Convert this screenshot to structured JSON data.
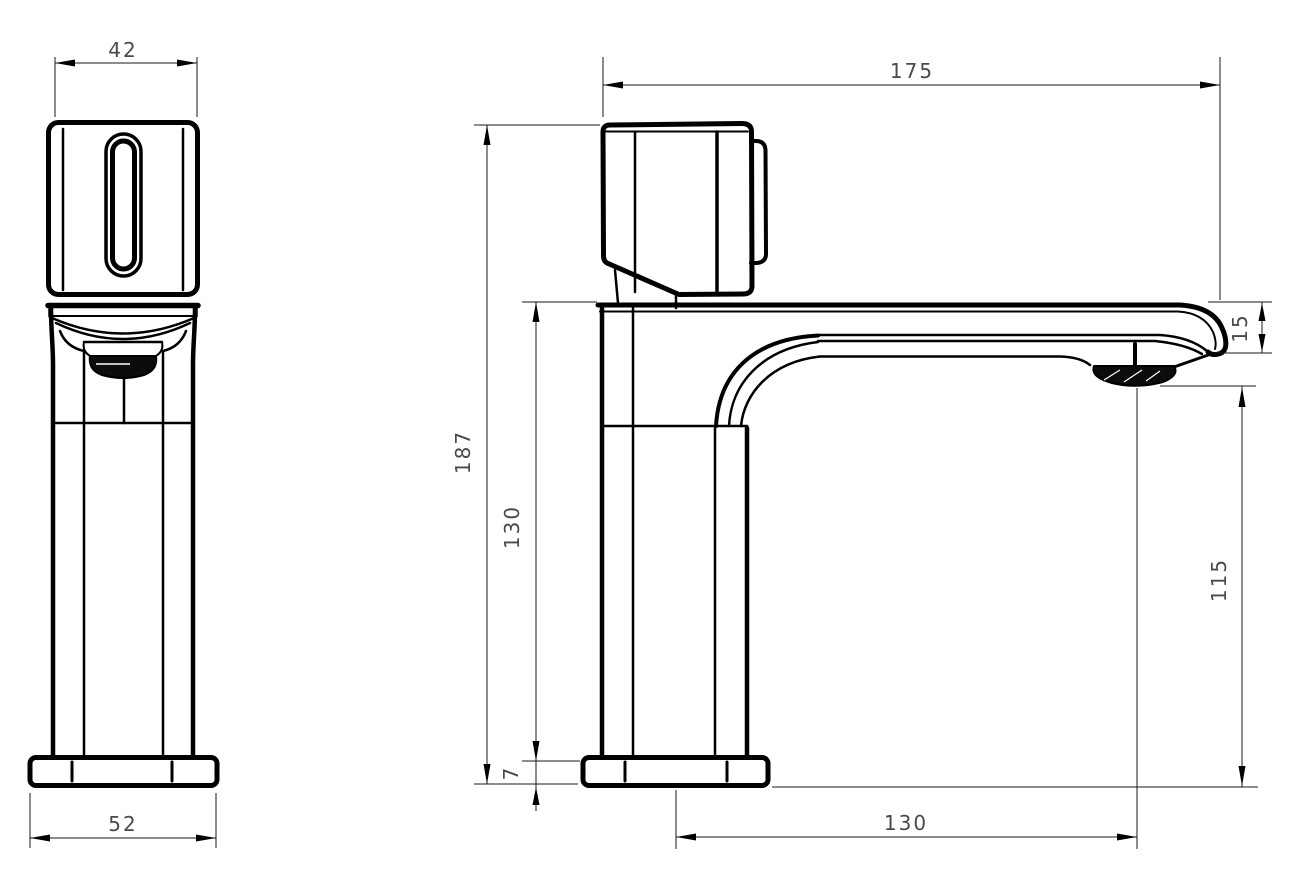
{
  "drawing": {
    "colors": {
      "background": "#ffffff",
      "line": "#000000",
      "dim_text": "#4a4a4a"
    },
    "views": {
      "front": {
        "dimensions": {
          "handle_width": "42",
          "base_width": "52"
        }
      },
      "side": {
        "dimensions": {
          "overall_length": "175",
          "overall_height": "187",
          "under_spout_height": "130",
          "base_thickness": "7",
          "tip_height": "15",
          "outlet_clearance": "115",
          "spout_reach": "130"
        }
      }
    }
  }
}
